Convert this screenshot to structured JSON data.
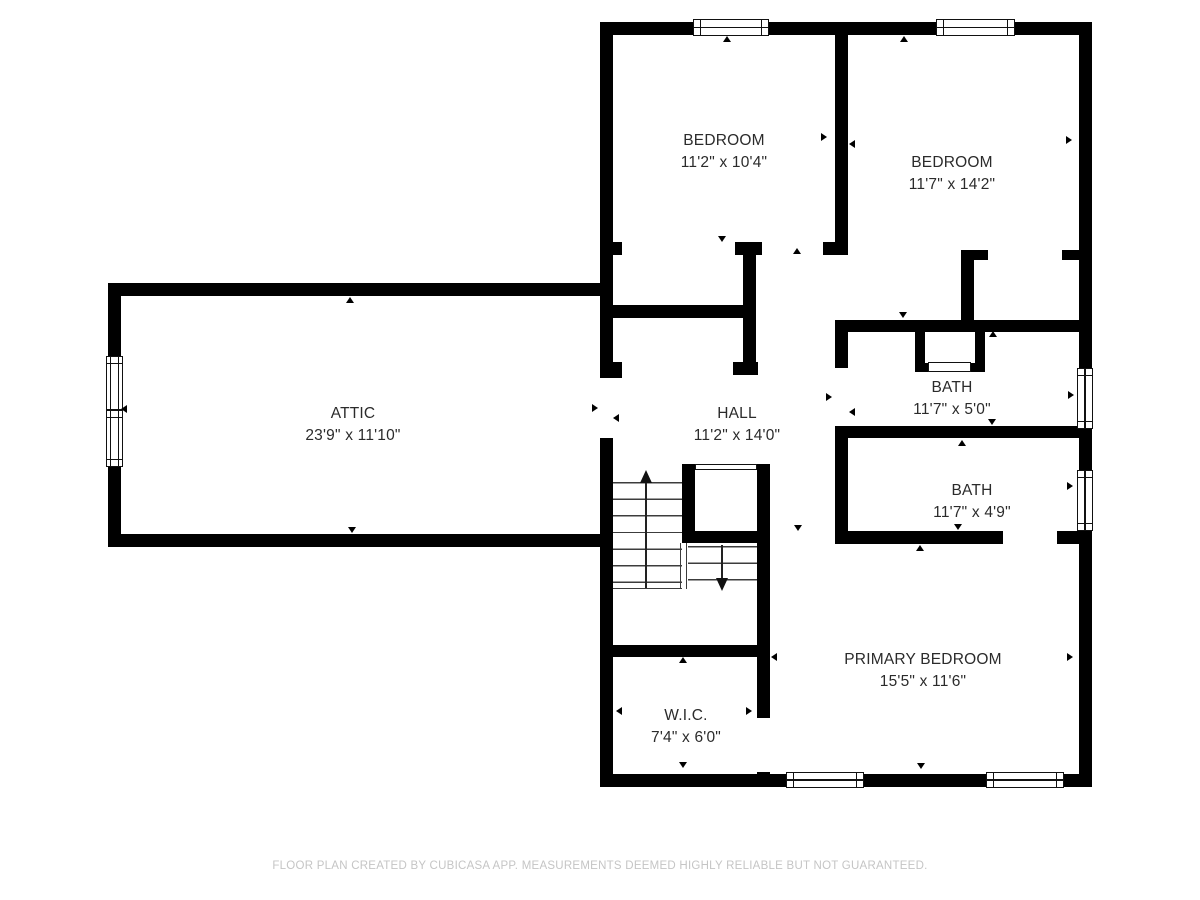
{
  "floorplan": {
    "rooms": {
      "bedroom1": {
        "name": "BEDROOM",
        "dims": "11'2\" x 10'4\""
      },
      "bedroom2": {
        "name": "BEDROOM",
        "dims": "11'7\" x 14'2\""
      },
      "attic": {
        "name": "ATTIC",
        "dims": "23'9\" x 11'10\""
      },
      "hall": {
        "name": "HALL",
        "dims": "11'2\" x 14'0\""
      },
      "bath1": {
        "name": "BATH",
        "dims": "11'7\" x 5'0\""
      },
      "bath2": {
        "name": "BATH",
        "dims": "11'7\" x 4'9\""
      },
      "primary_bedroom": {
        "name": "PRIMARY BEDROOM",
        "dims": "15'5\" x 11'6\""
      },
      "wic": {
        "name": "W.I.C.",
        "dims": "7'4\" x 6'0\""
      }
    },
    "footer": "FLOOR PLAN CREATED BY CUBICASA APP. MEASUREMENTS DEEMED HIGHLY RELIABLE BUT NOT GUARANTEED.",
    "colors": {
      "wall": "#000000",
      "background": "#ffffff",
      "label_text": "#2b2b2b",
      "footer_text": "#c5c5c5"
    }
  }
}
